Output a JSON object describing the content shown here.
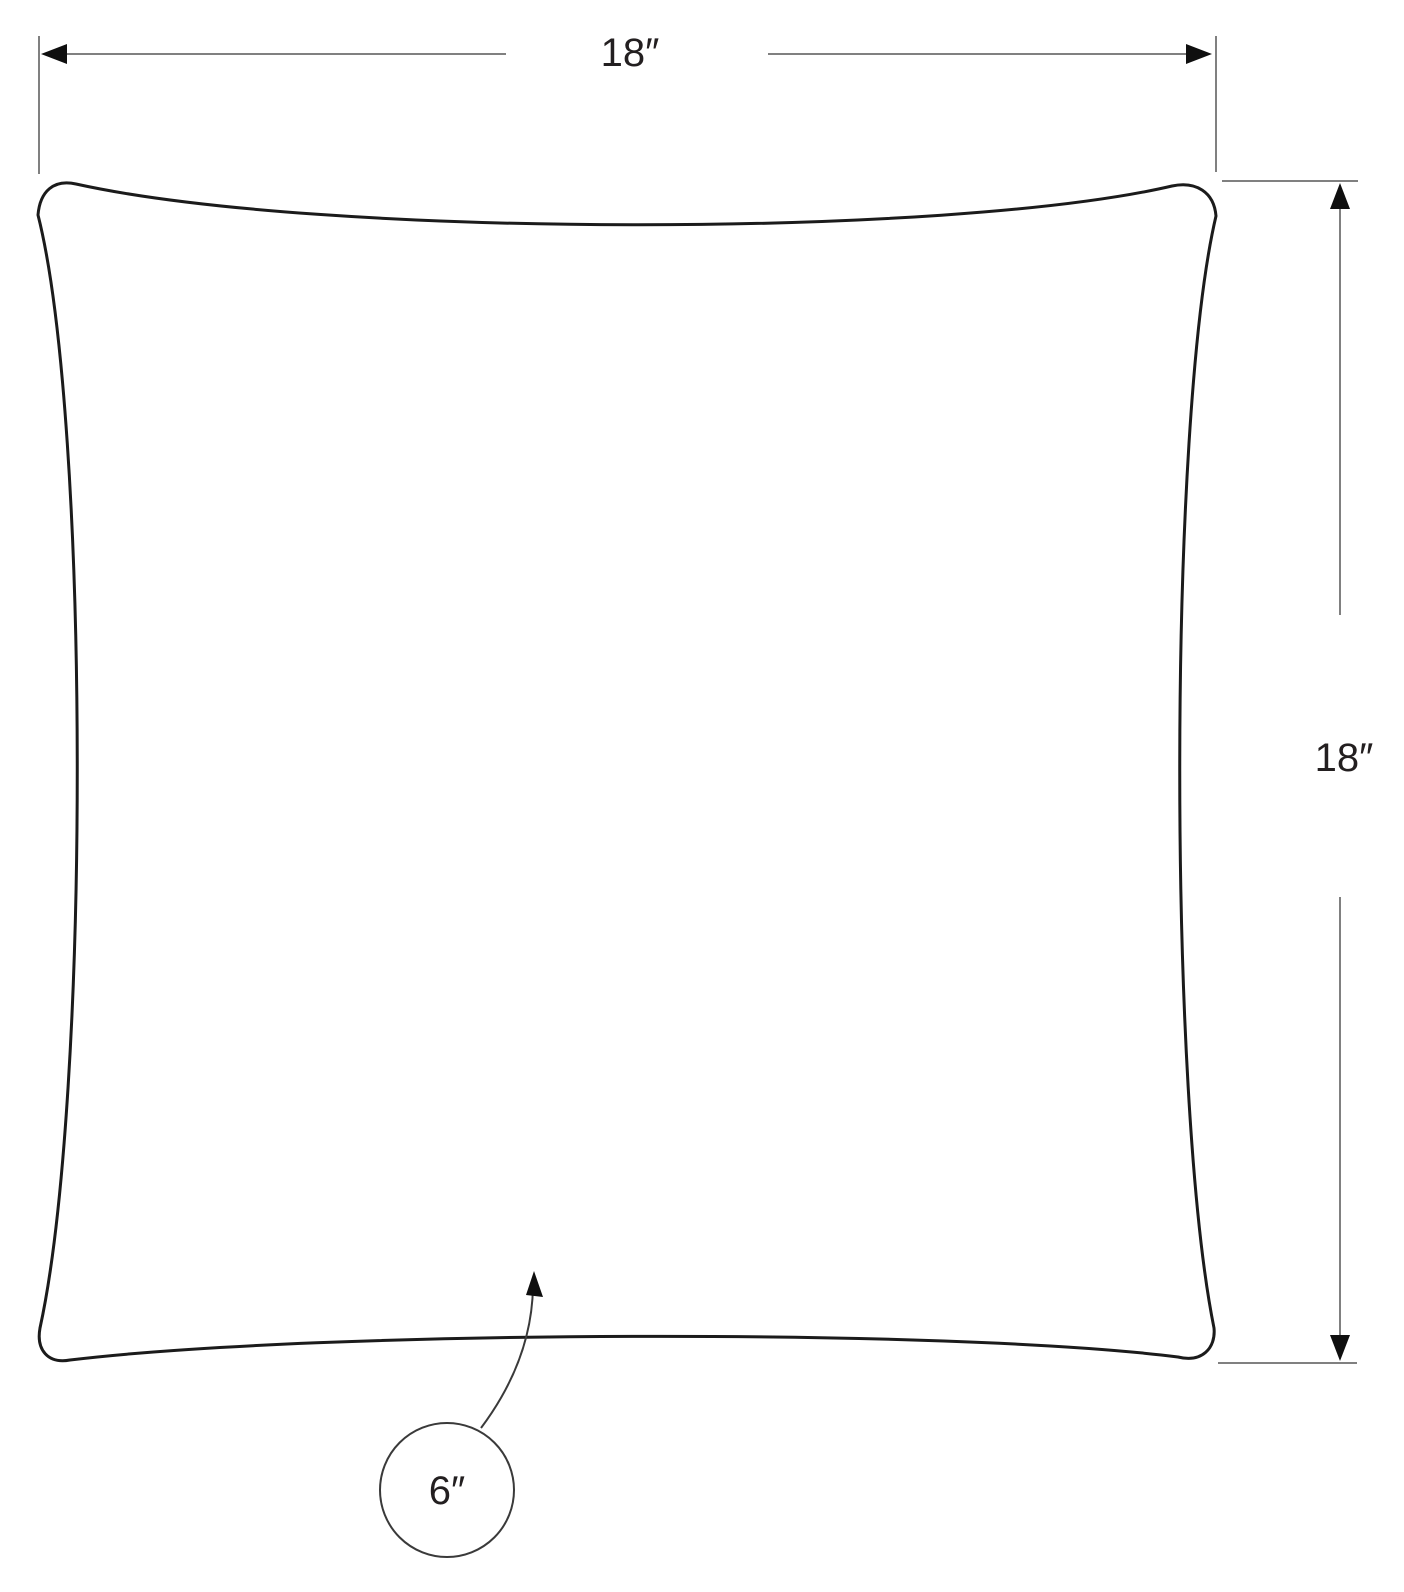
{
  "diagram": {
    "kind": "product-dimension-diagram",
    "subject": "pillow-outline",
    "dimensions": {
      "top": {
        "label": "18″"
      },
      "right": {
        "label": "18″"
      },
      "callout": {
        "label": "6″"
      }
    },
    "colors": {
      "background": "#ffffff",
      "outline": "#1b1b1b",
      "dimension_lines": "#808080",
      "arrowheads": "#0f0f0f",
      "callout": "#3a3a3a",
      "text": "#231f20"
    }
  }
}
